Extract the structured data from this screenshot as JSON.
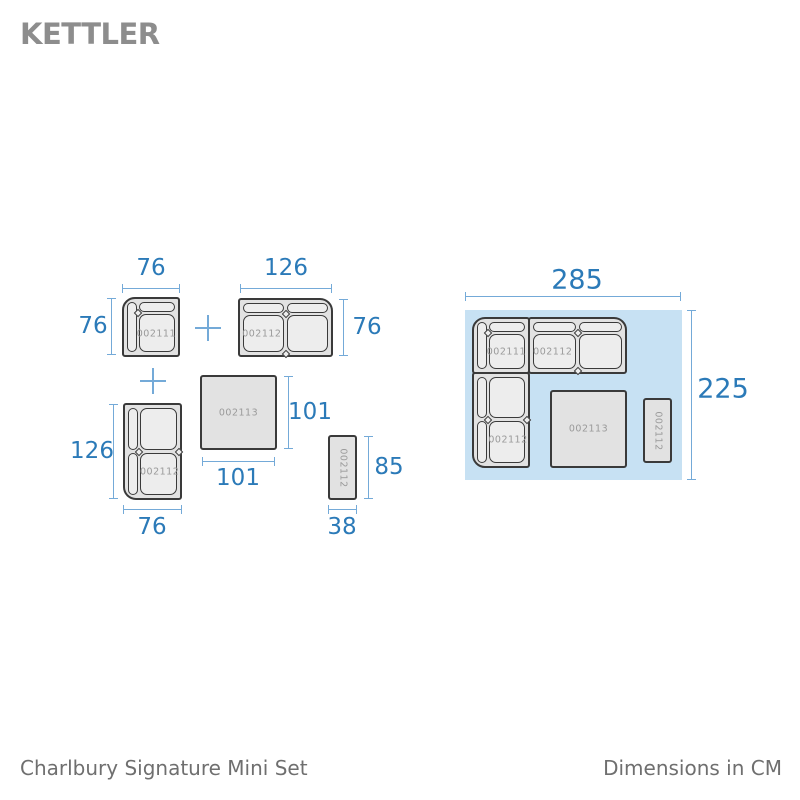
{
  "brand": {
    "logo_text": "KETTLER"
  },
  "footer": {
    "product_name": "Charlbury Signature Mini Set",
    "units_label": "Dimensions in CM"
  },
  "colors": {
    "dim_text": "#2b7ab8",
    "dim_line": "#74aad8",
    "panel_blue": "#c7e1f3",
    "outline": "#3a3a3a",
    "piece_base": "#e2e2e2",
    "cushion_fill": "#ededed",
    "sku_gray": "#9a9a9a",
    "logo_gray": "#8d8d8d",
    "footer_gray": "#6f6f6f"
  },
  "icons": {
    "separator": "plus-icon"
  },
  "pieces": {
    "corner_chair": {
      "sku": "002111",
      "width_cm": "76",
      "depth_cm": "76"
    },
    "sofa_horizontal": {
      "sku": "002112",
      "width_cm": "126",
      "depth_cm": "76"
    },
    "sofa_vertical": {
      "sku": "002112",
      "width_cm": "76",
      "depth_cm": "126"
    },
    "table": {
      "sku": "002113",
      "width_cm": "101",
      "depth_cm": "101"
    },
    "bench": {
      "sku": "002112",
      "width_cm": "38",
      "depth_cm": "85"
    }
  },
  "assembled": {
    "width_cm": "285",
    "depth_cm": "225"
  }
}
